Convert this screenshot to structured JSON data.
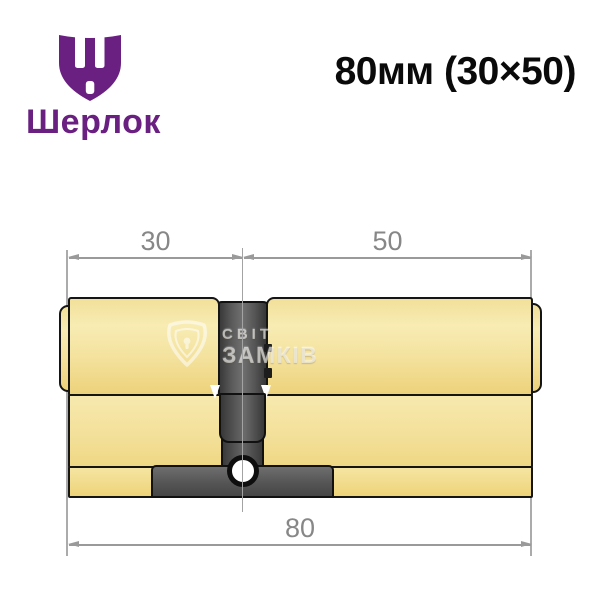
{
  "brand": {
    "name": "Шерлок",
    "logo_color": "#6A2080",
    "logo_icon": "shield-with-sha-letter"
  },
  "header": {
    "size_label": "80мм (30×50)"
  },
  "drawing": {
    "type": "technical-dimension-drawing",
    "subject": "euro-profile-lock-cylinder",
    "dimensions": {
      "left_mm": "30",
      "right_mm": "50",
      "total_mm": "80"
    },
    "colors": {
      "brass": "#F2E09A",
      "dark_metal": "#4A4A4A",
      "outline": "#151515",
      "dimension_gray": "#9A9A9A"
    }
  },
  "watermark": {
    "line1": "СВІТ",
    "line2": "ЗАМКІВ",
    "icon": "rounded-shield-keyhole"
  }
}
